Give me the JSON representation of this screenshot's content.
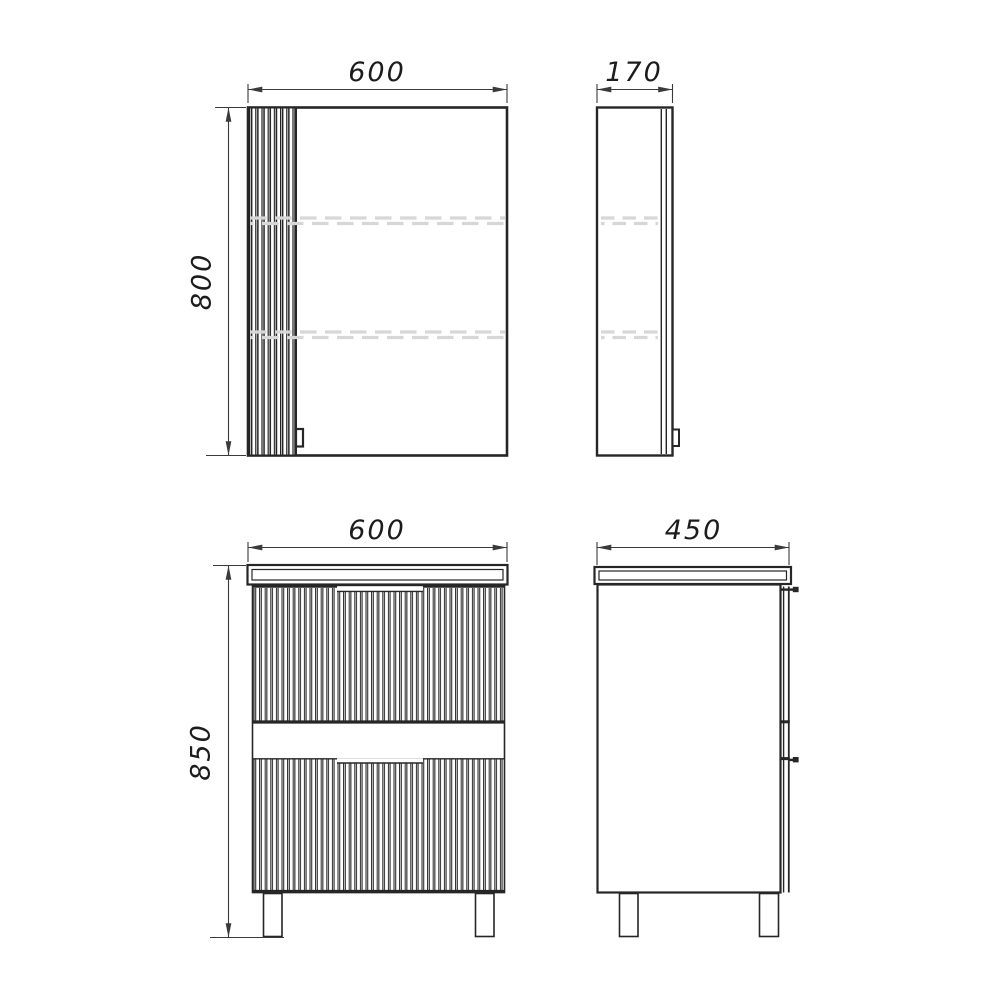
{
  "drawing": {
    "kind": "technical-drawing",
    "background_color": "#ffffff",
    "outline_color": "#262626",
    "dimension_color": "#3a3a3a",
    "hidden_line_color": "#d7d7d7",
    "views": {
      "mirror_cabinet_front": {
        "label_width": "600",
        "label_height": "800"
      },
      "mirror_cabinet_side": {
        "label_depth": "170"
      },
      "vanity_front": {
        "label_width": "600",
        "label_height": "850"
      },
      "vanity_side": {
        "label_depth": "450"
      }
    }
  }
}
